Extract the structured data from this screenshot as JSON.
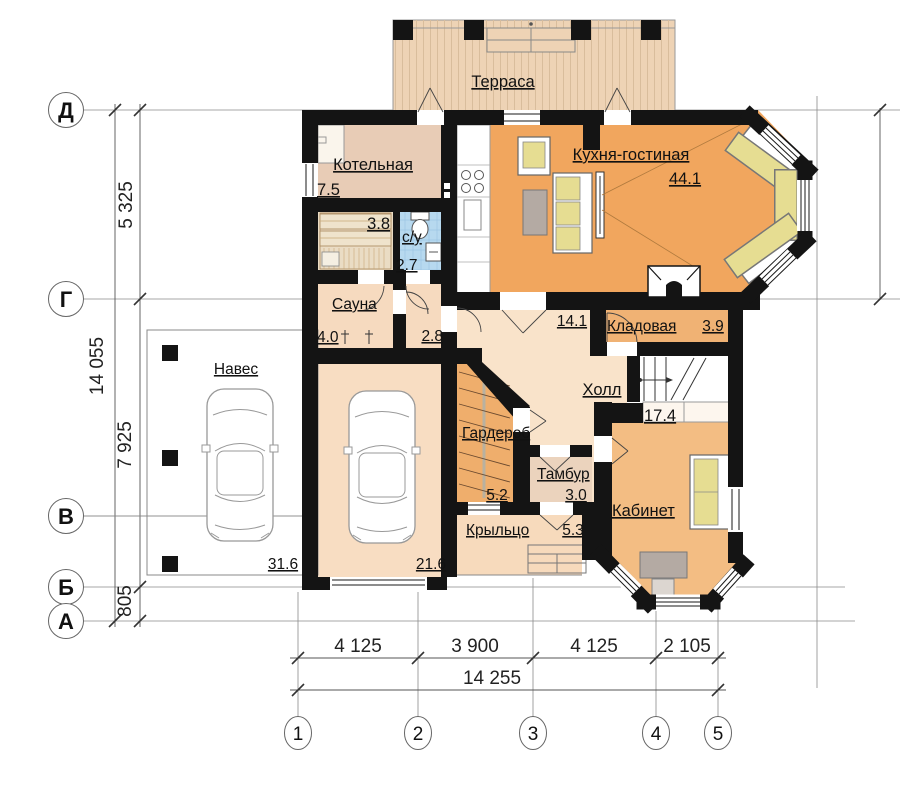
{
  "floorplan": {
    "rooms": {
      "terrace": {
        "label": "Терраса"
      },
      "boiler": {
        "label": "Котельная",
        "area": "7.5"
      },
      "steam_room": {
        "area": "3.8"
      },
      "bathroom": {
        "label": "с/у",
        "area": "2.7"
      },
      "sauna": {
        "label": "Сауна",
        "area": "4.0"
      },
      "corridor": {
        "area": "2.8"
      },
      "kitchen_living": {
        "label": "Кухня-гостиная",
        "area": "44.1"
      },
      "hall": {
        "label": "Холл",
        "area": "14.1"
      },
      "pantry": {
        "label": "Кладовая",
        "area": "3.9"
      },
      "office": {
        "label": "Кабинет",
        "area": "17.4"
      },
      "wardrobe": {
        "label": "Гардероб",
        "area": "5.2"
      },
      "vestibule": {
        "label": "Тамбур",
        "area": "3.0"
      },
      "porch": {
        "label": "Крыльцо",
        "area": "5.3"
      },
      "carport": {
        "label": "Навес",
        "area": "31.6"
      },
      "garage": {
        "area": "21.6"
      }
    },
    "axes": {
      "rows": [
        "Д",
        "Г",
        "В",
        "Б",
        "А"
      ],
      "cols": [
        "1",
        "2",
        "3",
        "4",
        "5"
      ]
    },
    "dimensions": {
      "left": {
        "segments": [
          "5 325",
          "7 925",
          "805"
        ],
        "total": "14 055"
      },
      "bottom": {
        "segments": [
          "4 125",
          "3 900",
          "4 125",
          "2 105"
        ],
        "total": "14 255"
      }
    },
    "colors": {
      "wall": "#141414",
      "terrace": "#eed3b5",
      "boiler": "#e8ccb6",
      "steam": "#eadcc4",
      "bathroom": "#b7d9ef",
      "sauna": "#f6dabf",
      "corridor": "#f6dabf",
      "kitchen": "#f1a65e",
      "hall": "#f9e3ca",
      "pantry": "#f0b274",
      "office": "#f3bd83",
      "wardrobe": "#efae6c",
      "vestibule": "#ebd3bd",
      "porch": "#f7dabc",
      "garage": "#f8ddc2",
      "cushion": "#e6dd92",
      "table_gray": "#b4aaa3"
    }
  }
}
